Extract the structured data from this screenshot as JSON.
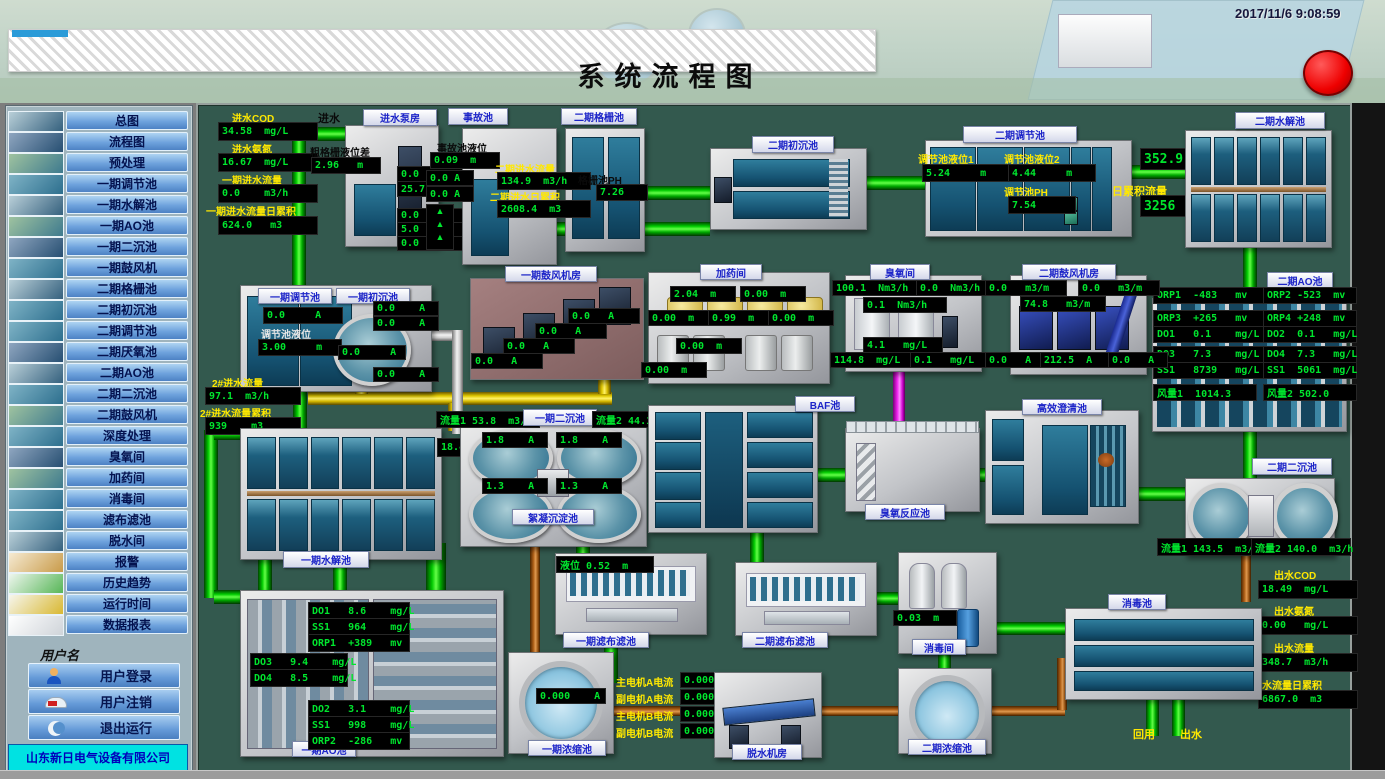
{
  "header": {
    "title": "系统流程图",
    "timestamp": "2017/11/6 9:08:59"
  },
  "sidebar": {
    "items": [
      "总图",
      "流程图",
      "预处理",
      "一期调节池",
      "一期水解池",
      "一期AO池",
      "一期二沉池",
      "一期鼓风机",
      "二期格栅池",
      "二期初沉池",
      "二期调节池",
      "二期厌氧池",
      "二期AO池",
      "二期二沉池",
      "二期鼓风机",
      "深度处理",
      "臭氧间",
      "加药间",
      "消毒间",
      "滤布滤池",
      "脱水间",
      "报警",
      "历史趋势",
      "运行时间",
      "数据报表"
    ],
    "username_label": "用户名",
    "login": "用户登录",
    "logout": "用户注销",
    "exit": "退出运行",
    "company": "山东新日电气设备有限公司"
  },
  "colors": {
    "accent_green": "#00e62e",
    "label_yellow": "#ffe800",
    "panel_bg": "#33594e",
    "alarm_red": "#ee0000"
  },
  "diagram": {
    "inlet": {
      "in_label": "进水",
      "cod_label": "进水COD",
      "cod": "34.58  mg/L",
      "nh3_label": "进水氨氮",
      "nh3": "16.67  mg/L",
      "flow_label": "一期进水流量",
      "flow": "0.0    m3/h",
      "total_label": "一期进水流量日累积",
      "total": "624.0   m3"
    },
    "pump_house": {
      "label": "进水泵房",
      "lvl_label": "粗格栅液位差",
      "lvl": "2.96   m",
      "a1": "0.0    A",
      "a2": "25.7   A",
      "a3": "0.0  A",
      "a4": "5.0  A",
      "a5": "0.0  A"
    },
    "accident": {
      "label": "事故池",
      "lvl_label": "事故池液位",
      "lvl": "0.09  m",
      "a1": "0.0 A",
      "a2": "0.0 A",
      "arrows": "▲\n▲\n▲"
    },
    "p2_grille": {
      "label": "二期格栅池",
      "flow_label": "二期进水流量",
      "flow": "134.9  m3/h",
      "total_label": "二期进水日累积",
      "total": "2608.4  m3",
      "ph_label": "格栅池PH",
      "ph": "7.26"
    },
    "p2_presettle": {
      "label": "二期初沉池"
    },
    "p2_reg": {
      "label": "二期调节池",
      "l1_label": "调节池液位1",
      "l1": "5.24     m",
      "l2_label": "调节池液位2",
      "l2": "4.44     m",
      "ph_label": "调节池PH",
      "ph": "7.54",
      "flow": "352.9  m3/h",
      "total_label": "日累积流量",
      "total": "3256   m3"
    },
    "p2_hydro": {
      "label": "二期水解池"
    },
    "p2_ao": {
      "label": "二期AO池",
      "r1a": "ORP1  -483   mv",
      "r1b": "ORP2 -523  mv",
      "r2a": "ORP3  +265   mv",
      "r2b": "ORP4 +248  mv",
      "r3a": "DO1   0.1    mg/L",
      "r3b": "DO2  0.1   mg/L",
      "r4a": "DO3   7.3    mg/L",
      "r4b": "DO4  7.3   mg/L",
      "r5a": "SS1   8739   mg/L",
      "r5b": "SS1  5061  mg/L",
      "r6a": "风量1  1014.3",
      "r6b": "风量2 502.0"
    },
    "p1_reg": {
      "label": "一期调节池",
      "a1": "0.0     A",
      "lvl_label": "调节池液位",
      "lvl": "3.00     m"
    },
    "p1_presettle": {
      "label": "一期初沉池",
      "a1": "0.0    A",
      "a2": "0.0    A",
      "a3": "0.0     A",
      "a4": "0.0    A"
    },
    "flow2": {
      "flow_label": "2#进水流量",
      "flow": "97.1  m3/h",
      "total_label": "2#进水流量累积",
      "total": "939    m3"
    },
    "p1_blower": {
      "label": "一期鼓风机房",
      "a1": "0.0   A",
      "a2": "0.0   A",
      "a3": "0.0   A",
      "a4": "0.0   A"
    },
    "dosing": {
      "label": "加药间",
      "v1": "2.04  m",
      "v2": "0.00  m",
      "v3": "0.00  m",
      "v4": "0.99  m",
      "v5": "0.00  m",
      "v6": "0.00  m",
      "v7": "0.00  m"
    },
    "ozone": {
      "label": "臭氧间",
      "v1": "100.1  Nm3/h",
      "v2": "0.0  Nm3/h",
      "v3": "0.1  Nm3/h",
      "v4": "4.1   mg/L",
      "v5": "114.8  mg/L",
      "v6": "0.1   mg/L"
    },
    "p2_blower": {
      "label": "二期鼓风机房",
      "v1": "0.0   m3/m",
      "v2": "0.0   m3/m",
      "v3": "74.8   m3/m",
      "a1": "0.0   A",
      "a2": "212.5  A",
      "a3": "0.0   A"
    },
    "p1_hydro": {
      "label": "一期水解池",
      "a1": "18.4       A"
    },
    "p1_sec": {
      "label": "一期二沉池",
      "f1": "流量1 53.8  m3/h",
      "f2": "流量2 44.1  m3/h",
      "a1": "1.8    A",
      "a2": "1.8    A",
      "a3": "1.3    A",
      "a4": "1.3    A",
      "floc_label": "絮凝沉淀池"
    },
    "baf": {
      "label": "BAF池"
    },
    "ozone_reactor": {
      "label": "臭氧反应池"
    },
    "clarifier": {
      "label": "高效澄清池"
    },
    "p2_sec": {
      "label": "二期二沉池",
      "f1": "流量1 143.5  m3/h",
      "f2": "流量2 140.0  m3/h"
    },
    "outlet": {
      "cod_label": "出水COD",
      "cod": "18.49  mg/L",
      "nh3_label": "出水氨氮",
      "nh3": "0.00   mg/L",
      "flow_label": "出水流量",
      "flow": "348.7  m3/h",
      "total_label": "出水流量日累积",
      "total": "6867.0  m3"
    },
    "disinfect_pool": {
      "label": "消毒池",
      "reuse": "回用",
      "out": "出水"
    },
    "disinfect_room": {
      "label": "消毒间",
      "lvl": "0.03  m"
    },
    "filter1": {
      "label": "一期滤布滤池",
      "lvl": "液位 0.52  m"
    },
    "filter2": {
      "label": "二期滤布滤池"
    },
    "thick1": {
      "label": "一期浓缩池",
      "a1": "0.000    A"
    },
    "thick2": {
      "label": "二期浓缩池"
    },
    "dewater": {
      "label": "脱水机房",
      "m1_label": "主电机A电流",
      "m1": "0.000",
      "m2_label": "副电机A电流",
      "m2": "0.000",
      "m3_label": "主电机B电流",
      "m3": "0.000",
      "m4_label": "副电机B电流",
      "m4": "0.000"
    },
    "p1_ao": {
      "label": "一期AO池",
      "b1r1": "DO1   8.6    mg/L",
      "b1r2": "SS1   964    mg/L",
      "b1r3": "ORP1  +389   mv",
      "b2r1": "DO3   9.4    mg/L",
      "b2r2": "DO4   8.5    mg/L",
      "b3r1": "DO2   3.1    mg/L",
      "b3r2": "SS1   998    mg/L",
      "b3r3": "ORP2  -286   mv"
    }
  }
}
